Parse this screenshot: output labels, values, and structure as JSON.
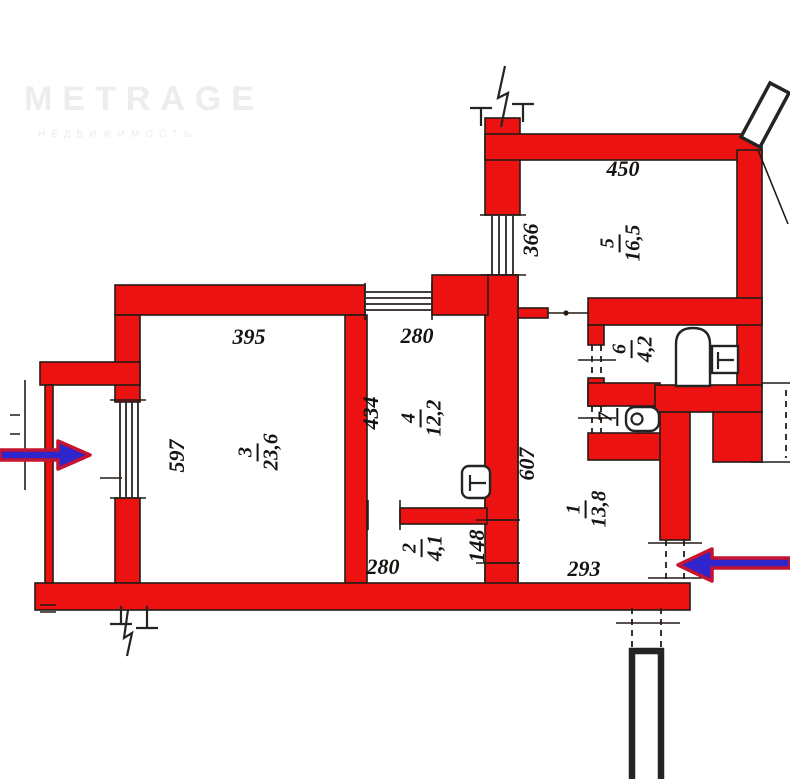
{
  "watermark": {
    "brand": "METRAGE",
    "subtitle": "НЕДВИЖИМОСТЬ"
  },
  "colors": {
    "wall_red": "#ed1212",
    "outline": "#241b16",
    "arrow_blue": "#2f25cc",
    "arrow_red": "#c41432",
    "watermark_gray": "#efedeb"
  },
  "rooms": {
    "r1": {
      "number": "1",
      "area": "13,8"
    },
    "r2": {
      "number": "2",
      "area": "4,1"
    },
    "r3": {
      "number": "3",
      "area": "23,6"
    },
    "r4": {
      "number": "4",
      "area": "12,2"
    },
    "r5": {
      "number": "5",
      "area": "16,5"
    },
    "r6": {
      "number": "6",
      "area": "4,2"
    },
    "r7": {
      "number": "7",
      "area": ""
    }
  },
  "dimensions": {
    "room5_width": "450",
    "room5_window": "366",
    "room3_width": "395",
    "room3_height": "597",
    "room4_width": "280",
    "room4_height": "434",
    "corridor_height": "607",
    "room2_width": "280",
    "opening_width": "148",
    "hall_width": "293"
  }
}
